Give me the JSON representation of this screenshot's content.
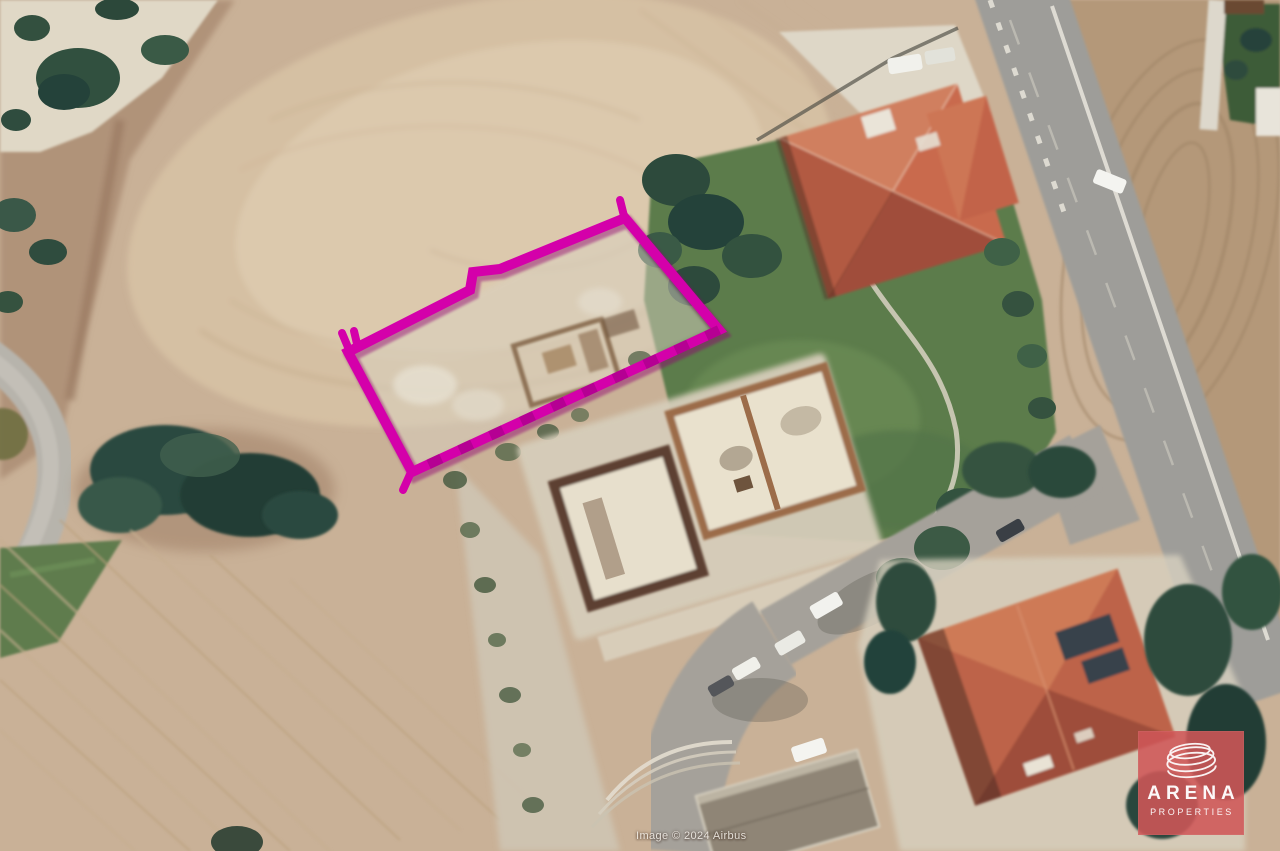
{
  "meta": {
    "type": "satellite-aerial-photo",
    "width_px": 1280,
    "height_px": 851
  },
  "attribution": {
    "text": "Image © 2024 Airbus"
  },
  "logo": {
    "brand": "ARENA",
    "tagline": "PROPERTIES",
    "bg_color": "#cf5658",
    "text_color": "#ffffff",
    "icon": "spiral-ellipses-icon"
  },
  "plot_overlay": {
    "label": "for-sale-plot-boundary",
    "color": "#d400aa",
    "shadow_color": "#8f0070",
    "points_attr": "348,352 470,290 473,272 500,269 625,218 719,330 412,472"
  },
  "scene": {
    "palette": {
      "field_tan": "#c9b197",
      "field_light": "#d8c4a8",
      "field_east_brown": "#b49879",
      "road_gray": "#9e9d99",
      "street_gray": "#a5a19a",
      "lawn_green": "#5c7c4c",
      "tree_dark_green": "#2f4c3e",
      "villa_roof_terracotta": "#c1634a",
      "construction_wall_brown": "#9c6c49",
      "paving_light": "#d8d1c0"
    },
    "features": [
      "plowed-field-northwest",
      "plowed-field-southwest",
      "plowed-field-east",
      "scrub-strip-west",
      "yard-northwest",
      "tree-cluster-west",
      "road-west-curve",
      "grass-strip-west",
      "main-road",
      "side-street",
      "villa-north-red-roof",
      "villa-southeast-red-roof",
      "construction-building-center",
      "garage-south-flat-roof",
      "parked-cars",
      "plot-boundary-overlay"
    ]
  }
}
